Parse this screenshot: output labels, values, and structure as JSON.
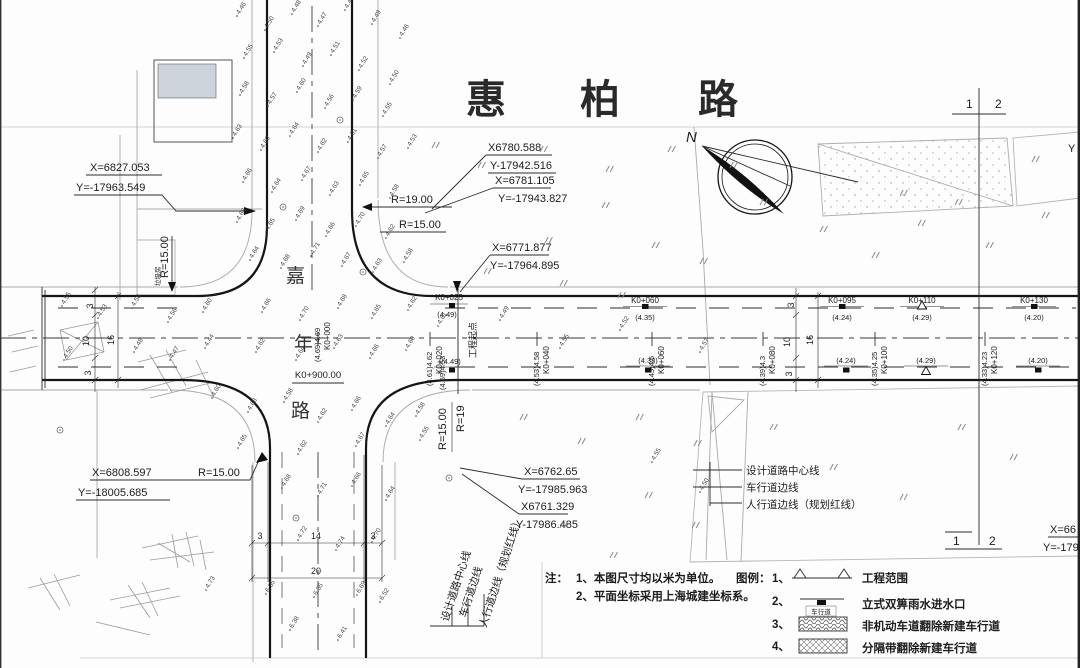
{
  "title": {
    "chars": [
      "惠",
      "柏",
      "路"
    ]
  },
  "cross_road": {
    "chars": [
      "嘉",
      "年",
      "路"
    ],
    "station": "K0+900.00"
  },
  "north": {
    "label": "N"
  },
  "markers_12": {
    "top": [
      "1",
      "2"
    ],
    "bottom": [
      "1",
      "2"
    ]
  },
  "edge": {
    "partial_y": "Y"
  },
  "callouts": {
    "nw": [
      "X=6827.053",
      "Y=-17963.549"
    ],
    "ne_a": [
      "X6780.588",
      "Y-17942.516"
    ],
    "ne_b": [
      "X=6781.105",
      "Y=-17943.827"
    ],
    "ne_c": [
      "X=6771.877",
      "Y=-17964.895"
    ],
    "sw": [
      "X=6808.597",
      "Y=-18005.685"
    ],
    "se_a": [
      "X=6762.65",
      "Y=-17985.963"
    ],
    "se_b": [
      "X6761.329",
      "Y-17986.485"
    ],
    "edge_partial": [
      "X=66",
      "Y=-179"
    ]
  },
  "radii": {
    "nw": "R=15.00",
    "ne_outer": "R=19.00",
    "ne_inner": "R=15.00",
    "sw": "R=15.00",
    "se_inner": "R=15.00",
    "se_outer": "R=19"
  },
  "project_start": {
    "station": "K0+025",
    "label": "工程起点",
    "elev_top": "(4.49)",
    "elev_bottom": "(4.49)",
    "elev_side": "(4.59)4.53"
  },
  "stations_rotated": [
    {
      "x": 318,
      "label": "K0+000",
      "elev": "(4.69)4.69"
    },
    {
      "x": 430,
      "label": "K0+020",
      "elev": "(4.61)4.62"
    },
    {
      "x": 537,
      "label": "K0+040",
      "elev": "(4.53)4.58"
    },
    {
      "x": 652,
      "label": "K0+060",
      "elev": "(4.45)4.5"
    },
    {
      "x": 763,
      "label": "K0+080",
      "elev": "(4.39)4.3"
    },
    {
      "x": 875,
      "label": "K0+100",
      "elev": "(4.35)4.25"
    },
    {
      "x": 985,
      "label": "K0+120",
      "elev": "(4.33)4.23"
    }
  ],
  "stations_top": [
    {
      "x": 645,
      "label": "K0+060",
      "elev": "(4.35)",
      "marker": "square"
    },
    {
      "x": 842,
      "label": "K0+095",
      "elev": "(4.24)",
      "marker": "square"
    },
    {
      "x": 922,
      "label": "K0+110",
      "elev": "(4.29)",
      "marker": "triangle"
    },
    {
      "x": 1034,
      "label": "K0+130",
      "elev": "(4.20)",
      "marker": "square"
    }
  ],
  "stations_bottom": [
    {
      "x": 648,
      "elev": "(4.38)",
      "marker": "square"
    },
    {
      "x": 846,
      "elev": "(4.24)",
      "marker": "square"
    },
    {
      "x": 926,
      "elev": "(4.29)",
      "marker": "triangle"
    },
    {
      "x": 1038,
      "elev": "(4.20)",
      "marker": "square"
    }
  ],
  "dimensions": {
    "left": [
      "3",
      "10",
      "16",
      "3"
    ],
    "right": [
      "3",
      "10",
      "16",
      "3"
    ],
    "bottom": [
      "3",
      "14",
      "3"
    ],
    "bottom_total": "20"
  },
  "line_labels": [
    "设计道路中心线",
    "车行道边线",
    "人行道边线（规划红线）"
  ],
  "building_label": "垃圾房",
  "notes": {
    "prefix": "注：",
    "lines": [
      "1、本图尺寸均以米为单位。",
      "2、平面坐标采用上海城建坐标系。"
    ]
  },
  "legend": {
    "prefix": "图例：",
    "items": [
      {
        "no": "1、",
        "text": "工程范围"
      },
      {
        "no": "2、",
        "text": "立式双箅雨水进水口",
        "symbol_label": "车行道"
      },
      {
        "no": "3、",
        "text": "非机动车道翻除新建车行道"
      },
      {
        "no": "4、",
        "text": "分隔带翻除新建车行道"
      }
    ]
  },
  "spot_elevations": [
    [
      237,
      16,
      "4.46"
    ],
    [
      265,
      30,
      "4.50"
    ],
    [
      292,
      14,
      "4.48"
    ],
    [
      318,
      26,
      "4.47"
    ],
    [
      345,
      10,
      "4.44"
    ],
    [
      372,
      24,
      "4.49"
    ],
    [
      400,
      38,
      "4.46"
    ],
    [
      244,
      58,
      "4.55"
    ],
    [
      274,
      52,
      "4.53"
    ],
    [
      303,
      66,
      "4.49"
    ],
    [
      331,
      55,
      "4.51"
    ],
    [
      359,
      70,
      "4.52"
    ],
    [
      390,
      84,
      "4.50"
    ],
    [
      240,
      95,
      "4.58"
    ],
    [
      268,
      106,
      "4.57"
    ],
    [
      297,
      92,
      "4.60"
    ],
    [
      325,
      108,
      "4.56"
    ],
    [
      353,
      100,
      "4.59"
    ],
    [
      383,
      116,
      "4.55"
    ],
    [
      233,
      138,
      "4.63"
    ],
    [
      261,
      150,
      "4.60"
    ],
    [
      290,
      136,
      "4.64"
    ],
    [
      318,
      152,
      "4.62"
    ],
    [
      348,
      142,
      "4.61"
    ],
    [
      378,
      158,
      "4.57"
    ],
    [
      408,
      148,
      "4.53"
    ],
    [
      243,
      182,
      "4.66"
    ],
    [
      272,
      192,
      "4.64"
    ],
    [
      302,
      180,
      "4.67"
    ],
    [
      330,
      195,
      "4.63"
    ],
    [
      360,
      185,
      "4.65"
    ],
    [
      390,
      198,
      "4.58"
    ],
    [
      237,
      222,
      "4.68"
    ],
    [
      266,
      232,
      "4.65"
    ],
    [
      296,
      220,
      "4.69"
    ],
    [
      326,
      236,
      "4.66"
    ],
    [
      356,
      226,
      "4.70"
    ],
    [
      386,
      238,
      "4.62"
    ],
    [
      250,
      260,
      "4.64"
    ],
    [
      281,
      268,
      "4.68"
    ],
    [
      311,
      256,
      "4.71"
    ],
    [
      342,
      266,
      "4.67"
    ],
    [
      373,
      272,
      "4.63"
    ],
    [
      404,
      262,
      "4.58"
    ],
    [
      62,
      306,
      "4.55"
    ],
    [
      98,
      318,
      "4.53"
    ],
    [
      132,
      308,
      "4.58"
    ],
    [
      168,
      322,
      "4.56"
    ],
    [
      203,
      312,
      "4.60"
    ],
    [
      134,
      352,
      "4.48"
    ],
    [
      170,
      360,
      "4.47"
    ],
    [
      205,
      348,
      "4.44"
    ],
    [
      64,
      360,
      "4.50"
    ],
    [
      262,
      312,
      "4.66"
    ],
    [
      300,
      320,
      "4.70"
    ],
    [
      338,
      308,
      "4.68"
    ],
    [
      372,
      318,
      "4.65"
    ],
    [
      408,
      310,
      "4.62"
    ],
    [
      256,
      352,
      "4.62"
    ],
    [
      296,
      360,
      "4.64"
    ],
    [
      334,
      348,
      "4.63"
    ],
    [
      370,
      358,
      "4.66"
    ],
    [
      406,
      350,
      "4.60"
    ],
    [
      438,
      326,
      "4.61"
    ],
    [
      500,
      320,
      "4.49"
    ],
    [
      560,
      348,
      "4.55"
    ],
    [
      620,
      330,
      "4.52"
    ],
    [
      700,
      352,
      "4.57"
    ],
    [
      212,
      398,
      "4.60"
    ],
    [
      248,
      412,
      "4.63"
    ],
    [
      284,
      402,
      "4.58"
    ],
    [
      318,
      422,
      "4.62"
    ],
    [
      352,
      410,
      "4.66"
    ],
    [
      386,
      426,
      "4.64"
    ],
    [
      416,
      416,
      "4.58"
    ],
    [
      238,
      448,
      "4.65"
    ],
    [
      298,
      454,
      "4.62"
    ],
    [
      356,
      446,
      "4.67"
    ],
    [
      420,
      440,
      "4.55"
    ],
    [
      282,
      488,
      "4.68"
    ],
    [
      318,
      496,
      "4.71"
    ],
    [
      352,
      486,
      "4.66"
    ],
    [
      386,
      500,
      "4.64"
    ],
    [
      298,
      540,
      "4.72"
    ],
    [
      336,
      550,
      "4.74"
    ],
    [
      372,
      542,
      "4.70"
    ],
    [
      206,
      590,
      "4.73"
    ],
    [
      266,
      594,
      "6.35"
    ],
    [
      314,
      597,
      "6.35"
    ],
    [
      357,
      595,
      "6.69"
    ],
    [
      380,
      602,
      "6.52"
    ],
    [
      290,
      630,
      "6.38"
    ],
    [
      338,
      640,
      "6.41"
    ],
    [
      652,
      462,
      "4.55"
    ],
    [
      700,
      492,
      "4.50"
    ]
  ],
  "ditto_marks": [
    [
      432,
      148
    ],
    [
      478,
      168
    ],
    [
      540,
      152
    ],
    [
      606,
      172
    ],
    [
      668,
      152
    ],
    [
      730,
      168
    ],
    [
      602,
      208
    ],
    [
      652,
      248
    ],
    [
      700,
      264
    ],
    [
      545,
      243
    ],
    [
      484,
      274
    ],
    [
      560,
      286
    ],
    [
      618,
      298
    ],
    [
      760,
      205
    ],
    [
      820,
      232
    ],
    [
      872,
      258
    ],
    [
      918,
      226
    ],
    [
      986,
      248
    ],
    [
      1042,
      218
    ],
    [
      900,
      196
    ],
    [
      520,
      420
    ],
    [
      578,
      444
    ],
    [
      636,
      420
    ],
    [
      694,
      446
    ],
    [
      645,
      498
    ],
    [
      692,
      528
    ],
    [
      560,
      528
    ],
    [
      610,
      558
    ],
    [
      958,
      430
    ],
    [
      1010,
      460
    ],
    [
      900,
      500
    ],
    [
      830,
      470
    ],
    [
      770,
      430
    ],
    [
      1032,
      162
    ],
    [
      955,
      205
    ]
  ],
  "survey_marks": [
    [
      363,
      272
    ],
    [
      340,
      120
    ],
    [
      283,
      207
    ],
    [
      449,
      478
    ],
    [
      296,
      518
    ],
    [
      60,
      430
    ]
  ]
}
